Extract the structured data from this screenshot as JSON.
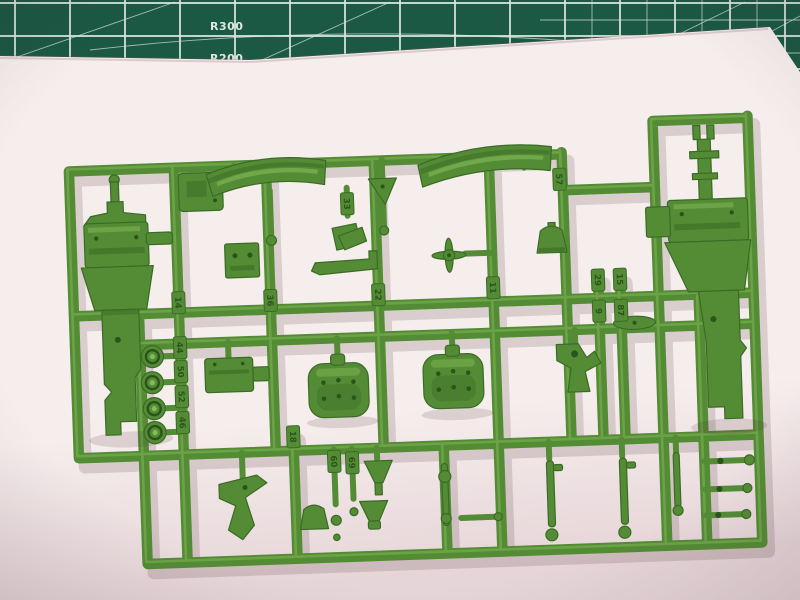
{
  "colors": {
    "mat": "#1b5944",
    "grid": "#dde8e0",
    "paper": "#f6eded",
    "paper_dark": "#e6d5d8",
    "green": "#548c36",
    "green_dark": "#3a6b25",
    "green_darker": "#2b541c",
    "green_light": "#85ba58"
  },
  "mat": {
    "labels": [
      "R300",
      "R200"
    ]
  },
  "sprue": {
    "material_color_name": "green",
    "part_tags": [
      {
        "number": "57",
        "x": 565,
        "y": 185
      },
      {
        "number": "33",
        "x": 352,
        "y": 202
      },
      {
        "number": "36",
        "x": 272,
        "y": 296
      },
      {
        "number": "22",
        "x": 380,
        "y": 294
      },
      {
        "number": "11",
        "x": 495,
        "y": 291
      },
      {
        "number": "14",
        "x": 180,
        "y": 295
      },
      {
        "number": "44",
        "x": 180,
        "y": 340
      },
      {
        "number": "50",
        "x": 180,
        "y": 364
      },
      {
        "number": "52",
        "x": 180,
        "y": 389
      },
      {
        "number": "46",
        "x": 180,
        "y": 415
      },
      {
        "number": "18",
        "x": 290,
        "y": 433
      },
      {
        "number": "60",
        "x": 330,
        "y": 459
      },
      {
        "number": "69",
        "x": 348,
        "y": 461
      },
      {
        "number": "29",
        "x": 600,
        "y": 287
      },
      {
        "number": "15",
        "x": 622,
        "y": 287
      },
      {
        "number": "9",
        "x": 600,
        "y": 318
      },
      {
        "number": "87",
        "x": 622,
        "y": 318
      }
    ]
  }
}
